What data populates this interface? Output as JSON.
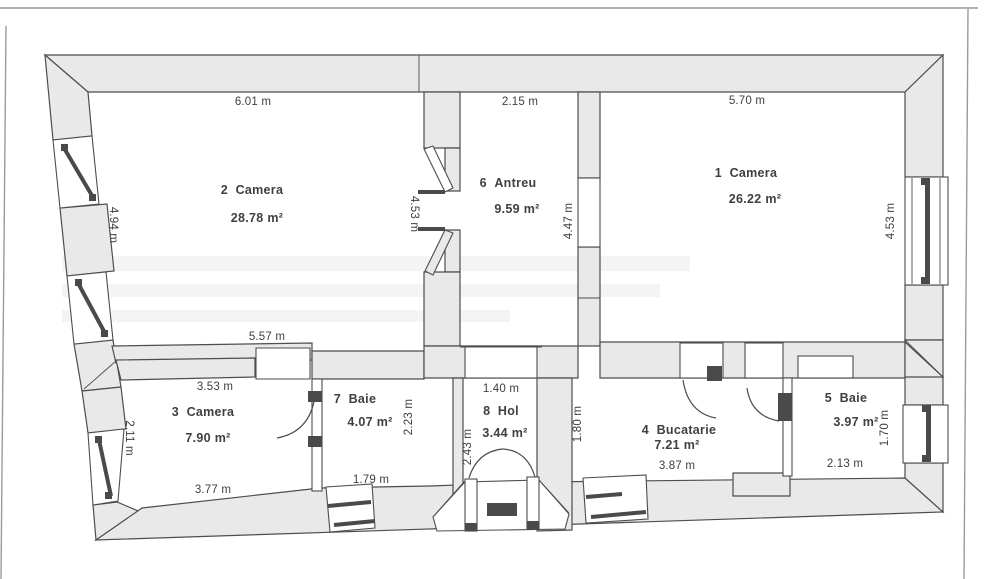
{
  "document": {
    "type": "apartment floor plan scan"
  },
  "colors": {
    "wall_fill": "#e9e9e9",
    "outline": "#4d4d4d",
    "hardware_dark": "#4a4a4a",
    "text": "#3f3f3f",
    "page_border": "#9a9a9a",
    "watermark": "#f4f4f4"
  },
  "rooms": {
    "r1": {
      "label": "1  Camera",
      "area": "26.22 m²"
    },
    "r2": {
      "label": "2  Camera",
      "area": "28.78 m²"
    },
    "r3": {
      "label": "3  Camera",
      "area": "7.90 m²"
    },
    "r4": {
      "label": "4  Bucatarie",
      "area": "7.21 m²"
    },
    "r5": {
      "label": "5  Baie",
      "area": "3.97 m²"
    },
    "r6": {
      "label": "6  Antreu",
      "area": "9.59 m²"
    },
    "r7": {
      "label": "7  Baie",
      "area": "4.07 m²"
    },
    "r8": {
      "label": "8  Hol",
      "area": "3.44 m²"
    }
  },
  "dims": {
    "top_r2": "6.01 m",
    "top_r6": "2.15 m",
    "top_r1": "5.70 m",
    "left_r2": "4.94 m",
    "left_r3": "2.11 m",
    "antreu_left": "4.53 m",
    "antreu_right": "4.47 m",
    "right_r1": "4.53 m",
    "right_r5": "1.70 m",
    "wall_557": "5.57 m",
    "wall_353": "3.53 m",
    "hol_top": "1.40 m",
    "r3_bottom": "3.77 m",
    "r7_bottom": "1.79 m",
    "r7_right": "2.23 m",
    "hol_left": "2.43 m",
    "buc_left": "1.80 m",
    "buc_bottom": "3.87 m",
    "baie5_bottom": "2.13 m"
  }
}
